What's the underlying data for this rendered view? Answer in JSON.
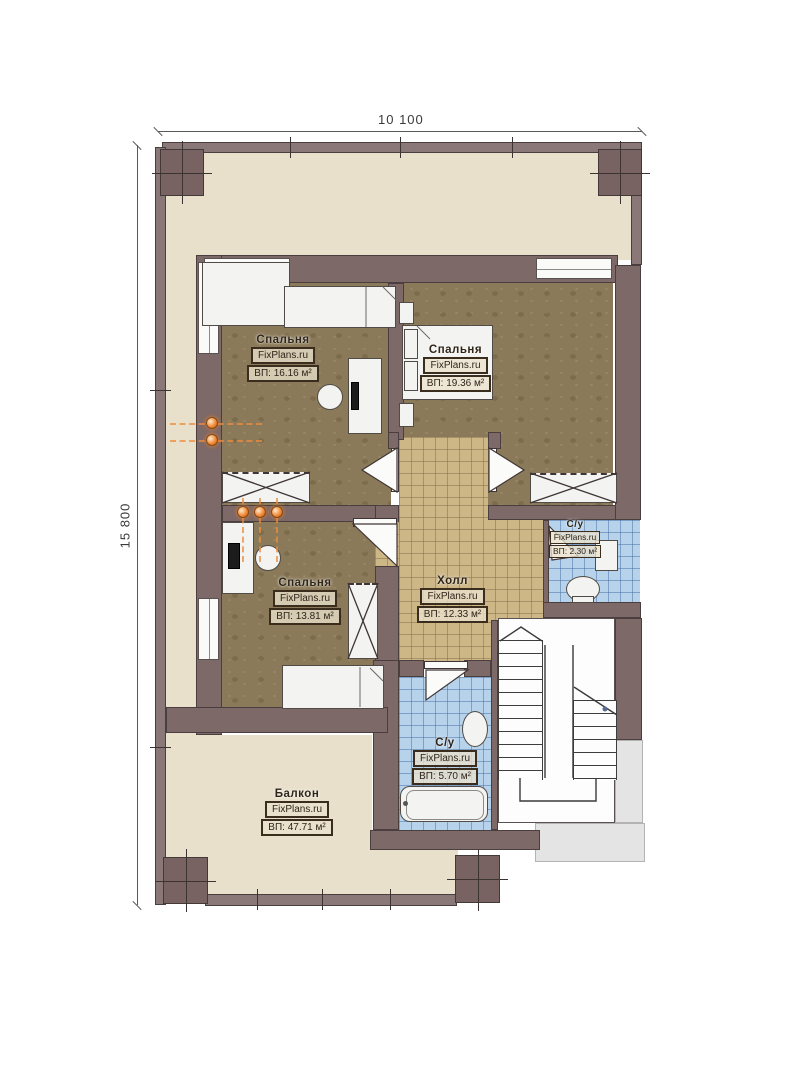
{
  "dimensions": {
    "width_label": "10 100",
    "height_label": "15 800"
  },
  "rooms": {
    "bedroom_top_left": {
      "name": "Спальня",
      "brand": "FixPlans.ru",
      "area": "ВП: 16.16 м²"
    },
    "bedroom_top_right": {
      "name": "Спальня",
      "brand": "FixPlans.ru",
      "area": "ВП: 19.36 м²"
    },
    "bedroom_bottom_left": {
      "name": "Спальня",
      "brand": "FixPlans.ru",
      "area": "ВП: 13.81 м²"
    },
    "hall": {
      "name": "Холл",
      "brand": "FixPlans.ru",
      "area": "ВП: 12.33 м²"
    },
    "bathroom_top": {
      "name": "С/у",
      "brand": "FixPlans.ru",
      "area": "ВП: 2.30 м²"
    },
    "bathroom_bottom": {
      "name": "С/у",
      "brand": "FixPlans.ru",
      "area": "ВП: 5.70 м²"
    },
    "balcony": {
      "name": "Балкон",
      "brand": "FixPlans.ru",
      "area": "ВП: 47.71 м²"
    }
  },
  "colors": {
    "wall": "#7c6968",
    "carpet": "#8b7a59",
    "hall_tile": "#cdb787",
    "bath_tile": "#b7d3ec",
    "terrace": "#e8e0cb",
    "lamp_accent": "#f08228"
  }
}
